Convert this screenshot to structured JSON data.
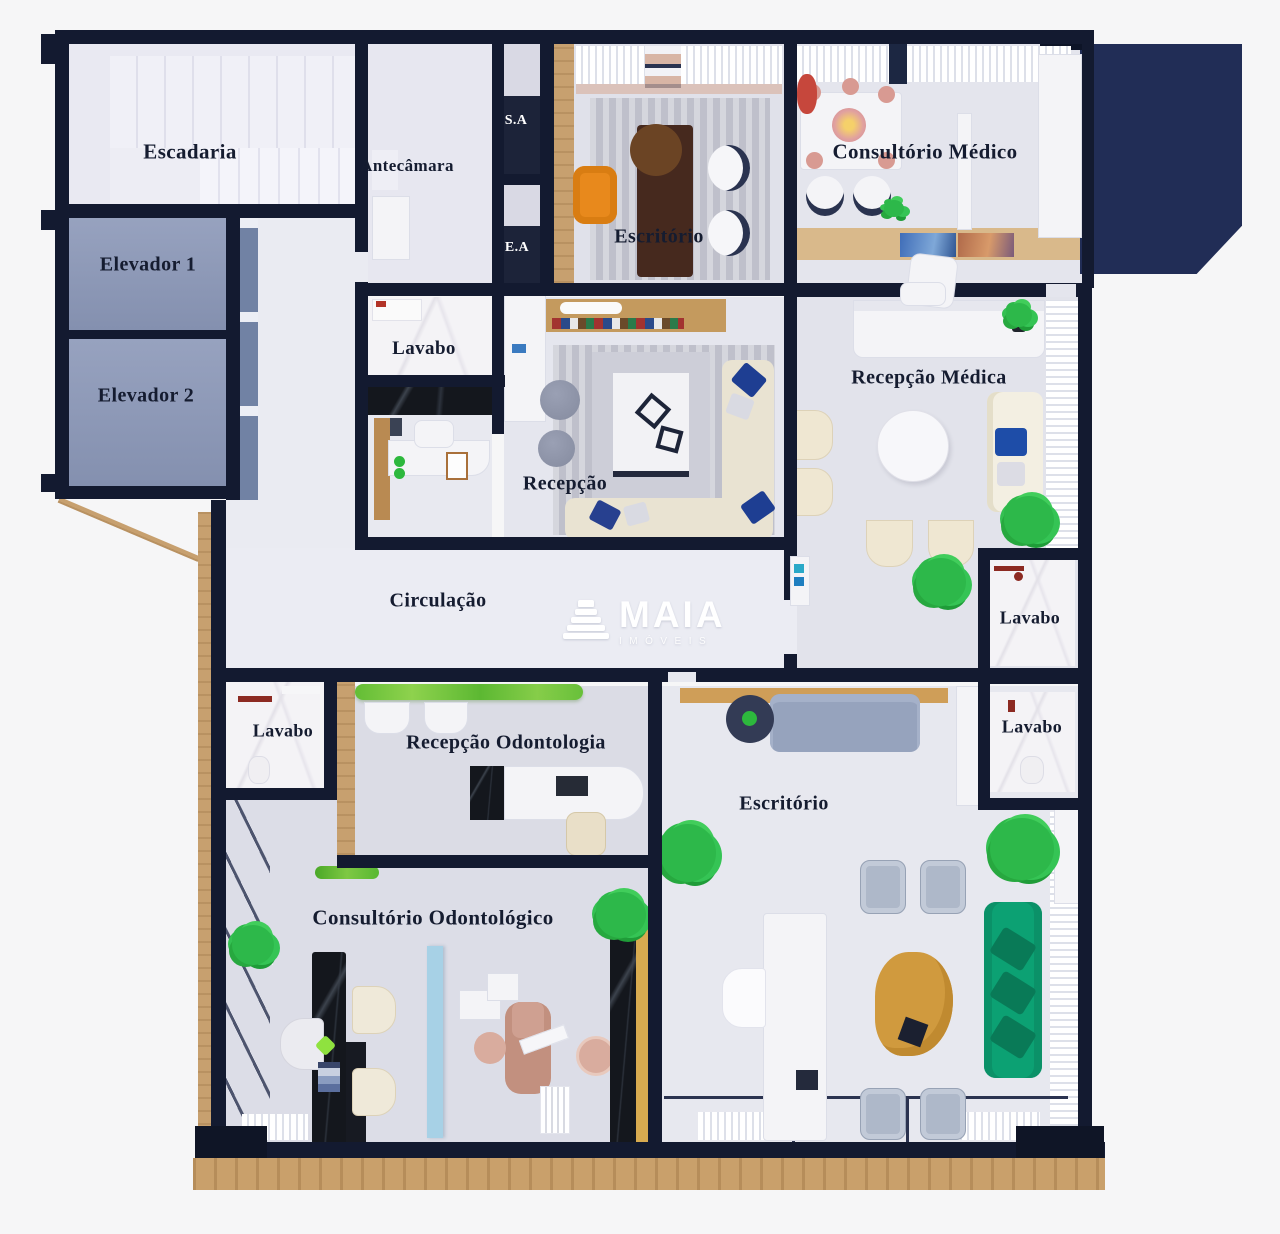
{
  "title": "Planta humanizada - pavimento de consultórios",
  "watermark": {
    "brand": "MAIA",
    "subtitle": "IMÓVEIS"
  },
  "rooms": {
    "escadaria": {
      "label": "Escadaria"
    },
    "elevador_1": {
      "label": "Elevador 1"
    },
    "elevador_2": {
      "label": "Elevador 2"
    },
    "antecamara": {
      "label": "Antecâmara"
    },
    "shaft_sa": {
      "label": "S.A"
    },
    "shaft_ea": {
      "label": "E.A"
    },
    "escritorio_superior": {
      "label": "Escritório"
    },
    "consultorio_medico": {
      "label": "Consultório Médico"
    },
    "lavabo_recepcao": {
      "label": "Lavabo"
    },
    "recepcao": {
      "label": "Recepção"
    },
    "recepcao_medica": {
      "label": "Recepção Médica"
    },
    "circulacao": {
      "label": "Circulação"
    },
    "lavabo_direito_superior": {
      "label": "Lavabo"
    },
    "lavabo_direito_inferior": {
      "label": "Lavabo"
    },
    "lavabo_odontologia": {
      "label": "Lavabo"
    },
    "recepcao_odontologia": {
      "label": "Recepção Odontologia"
    },
    "escritorio_inferior": {
      "label": "Escritório"
    },
    "consultorio_odontologico": {
      "label": "Consultório Odontológico"
    }
  },
  "colors": {
    "wall": "#131a30",
    "navy_mass": "#212d56",
    "elevator_fill": "#8d99b7",
    "floor_light": "#e6e7ee",
    "corridor": "#ebecf3",
    "wood": "#c7a06f",
    "hedge_green": "#6cc23e",
    "plant_green": "#2db84a",
    "emerald_sofa": "#0ca173",
    "amber_table": "#d09a3e",
    "navy_pillow": "#1e3e92",
    "orange_chair": "#e8891c",
    "blue_partition": "#a7d1e6",
    "dental_chair": "#c2907f",
    "cream_seat": "#efe7d2",
    "gray_sofa": "#96a3bd",
    "black_marble": "#14171d",
    "label_text": "#151c30",
    "watermark_white": "#ffffff"
  }
}
